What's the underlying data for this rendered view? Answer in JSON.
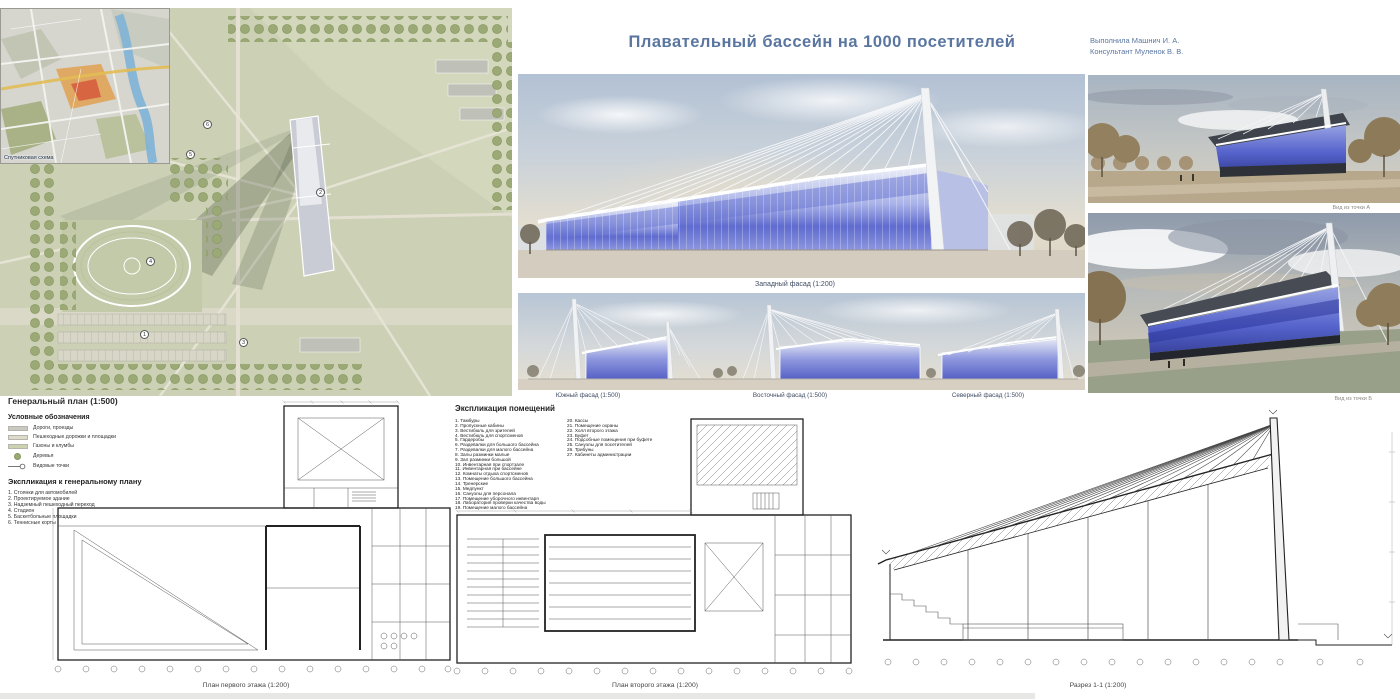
{
  "title": "Плавательный бассейн на 1000 посетителей",
  "authors": {
    "line1": "Выполнила Машнич И. А.",
    "line2": "Консультант Муленок В. В."
  },
  "satellite": {
    "label": "Спутниковая схема"
  },
  "facades": {
    "west": "Западный фасад (1:200)",
    "south": "Южный фасад (1:500)",
    "east": "Восточный фасад (1:500)",
    "north": "Северный фасад (1:500)"
  },
  "views": {
    "a": "Вид из точки А",
    "b": "Вид из точки Б"
  },
  "genplan": {
    "title": "Генеральный план (1:500)",
    "legend_title": "Условные обозначения",
    "legend": [
      "Дороги, проезды",
      "Пешеходные дорожки и площадки",
      "Газоны и клумбы",
      "Деревья",
      "Видовые точки"
    ],
    "explication_title": "Экспликация к генеральному плану",
    "explication": [
      "1. Стоянки для автомобилей",
      "2. Проектируемое здание",
      "3. Надземный пешеходный переход",
      "4. Стадион",
      "5. Баскетбольные площадки",
      "6. Теннисные корты"
    ],
    "markers": [
      "1",
      "2",
      "3",
      "4",
      "5",
      "6"
    ]
  },
  "rooms": {
    "title": "Экспликация помещений",
    "col1": [
      "1. Тамбуры",
      "2. Пропускные кабины",
      "3. Вестибюль для зрителей",
      "4. Вестибюль для спортсменов",
      "5. Гардеробы",
      "6. Раздевалки для большого бассейна",
      "7. Раздевалки для малого бассейна",
      "8. Залы разминки малые",
      "9. Зал разминки большой",
      "10. Инвентарная при спортзале",
      "11. Инвентарная при бассейне",
      "12. Комнаты отдыха спортсменов",
      "13. Помещение большого бассейна",
      "14. Тренерские",
      "15. Медпункт",
      "16. Санузлы для персонала",
      "17. Помещение уборочного инвентаря",
      "18. Лаборатория проверки качества воды",
      "19. Помещение малого бассейна"
    ],
    "col2": [
      "20. Кассы",
      "21. Помещение охраны",
      "22. Холл второго этажа",
      "23. Буфет",
      "24. Подсобные помещения при буфете",
      "25. Санузлы для посетителей",
      "26. Трибуны",
      "27. Кабинеты администрации"
    ]
  },
  "drawings": {
    "plan1": "План первого этажа (1:200)",
    "plan2": "План второго этажа (1:200)",
    "section": "Разрез 1-1 (1:200)"
  },
  "colors": {
    "accent": "#5a76a0",
    "glass": "#5f6bce",
    "site_green": "#ccd1b5"
  }
}
